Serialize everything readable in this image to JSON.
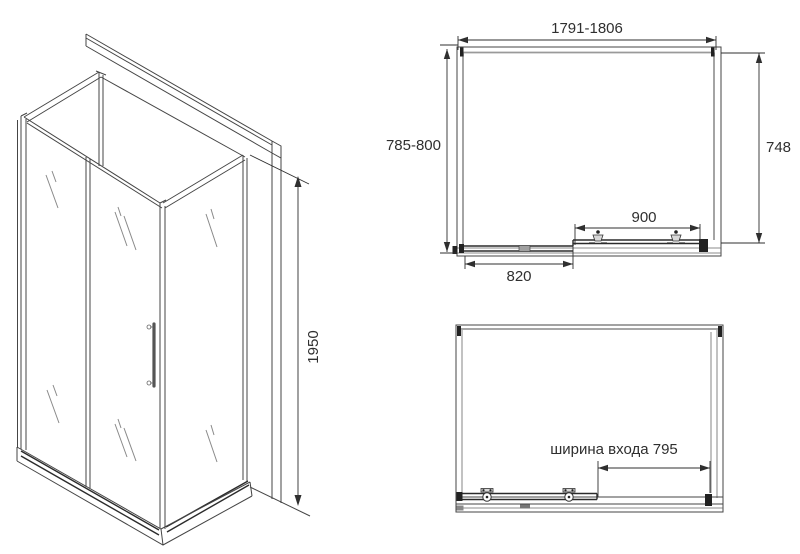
{
  "colors": {
    "background": "#ffffff",
    "line": "#454545",
    "glass_edge": "#9a9a9a",
    "dimension": "#2f2f2f"
  },
  "views": {
    "iso": {
      "height_dim": "1950"
    },
    "plan": {
      "overall_width_dim": "1791-1806",
      "overall_depth_dim": "785-800",
      "side_dim": "748",
      "door_dim": "900",
      "fixed_panel_dim": "820"
    },
    "front": {
      "entrance_dim": "ширина входа 795"
    }
  }
}
